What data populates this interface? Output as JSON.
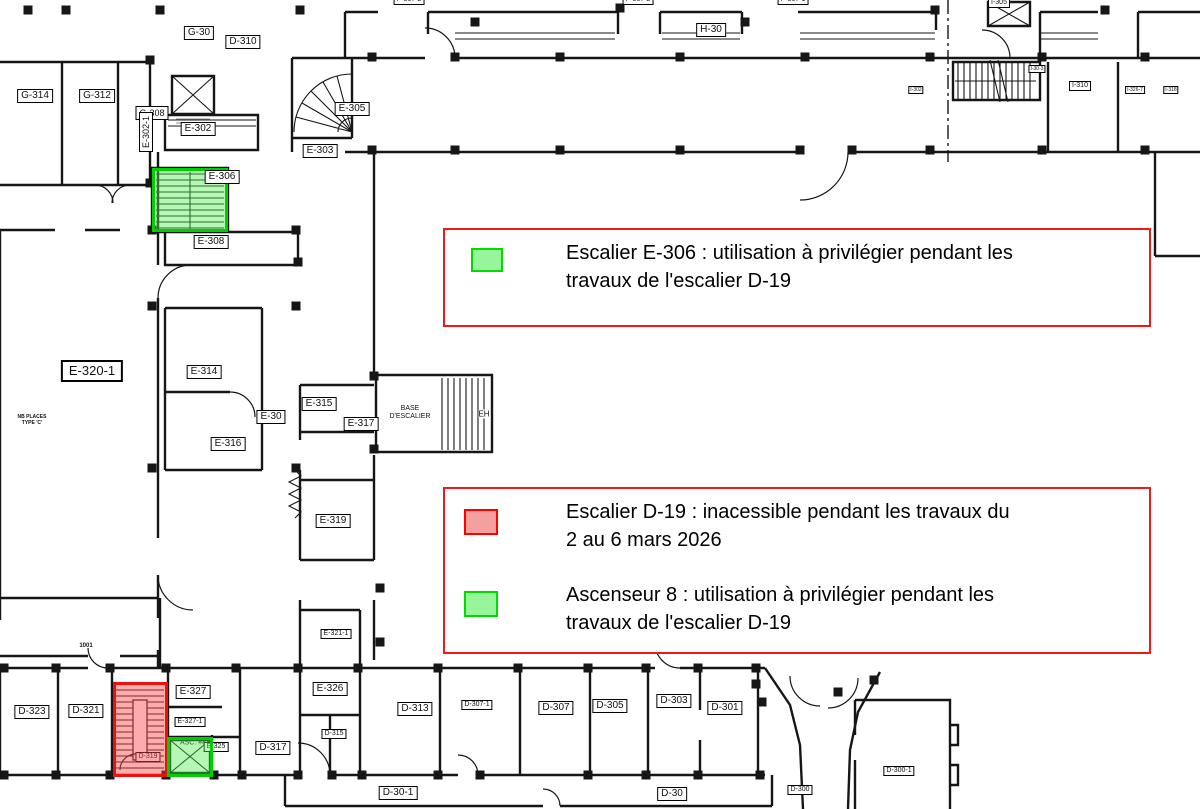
{
  "colors": {
    "line": "#161616",
    "legend_border": "#f21818",
    "highlight_green_fill": "rgba(80,235,80,0.42)",
    "highlight_green_border": "#00ce00",
    "highlight_red_fill": "rgba(250,70,70,0.45)",
    "highlight_red_border": "#ee0f0f",
    "swatch_green_fill": "#99f599",
    "swatch_green_border": "#00dc00",
    "swatch_red_fill": "#f5a0a0",
    "swatch_red_border": "#ff0000"
  },
  "legend": {
    "box1": {
      "item1": {
        "swatch_color": "green",
        "text": "Escalier E-306 : utilisation à privilégier pendant les\ntravaux de l'escalier D-19"
      }
    },
    "box2": {
      "item1": {
        "swatch_color": "red",
        "text": "Escalier D-19 : inacessible pendant les travaux du\n2 au 6 mars 2026"
      },
      "item2": {
        "swatch_color": "green",
        "text": "Ascenseur 8 : utilisation à privilégier pendant les\ntravaux de l'escalier D-19"
      }
    }
  },
  "highlights": {
    "escalier_e306": "green",
    "escalier_d19": "red",
    "ascenseur_8": "green"
  },
  "rooms": {
    "g30": "G-30",
    "d310": "D-310",
    "g314": "G-314",
    "g312": "G-312",
    "g308": "G-308",
    "e302_1": "E-302-1",
    "e302": "E-302",
    "e305": "E-305",
    "e303": "E-303",
    "e306": "E-306",
    "e308": "E-308",
    "h30": "H-30",
    "p307_2a": "P-307-2",
    "p307_2b": "P-307-2",
    "p307_1": "P-307-1",
    "i305": "I-305",
    "i302": "I-302",
    "i30_3": "I-30-3",
    "i310": "I-310",
    "i326_7": "I-326-7",
    "i318": "I-318",
    "e320_1": "E-320-1",
    "e314": "E-314",
    "e315": "E-315",
    "e30": "E-30",
    "e317": "E-317",
    "e316": "E-316",
    "e319": "E-319",
    "e321_1": "E-321-1",
    "e326": "E-326",
    "e327": "E-327",
    "e327_1": "E-327-1",
    "e325": "E-325",
    "d323": "D-323",
    "d321": "D-321",
    "d319": "D-319",
    "d317": "D-317",
    "d315": "D-315",
    "d313": "D-313",
    "d307_1": "D-307-1",
    "d307": "D-307",
    "d305": "D-305",
    "d303": "D-303",
    "d301": "D-301",
    "d300": "D-300",
    "d300_1": "D-300-1",
    "d30_1": "D-30-1",
    "d30": "D-30"
  },
  "annotations": {
    "base_escalier": "BASE\nD'ESCALIER",
    "eh": "EH",
    "places": "NB PLACES\nTYPE 'C'",
    "room1001": "1001",
    "asc8": "ASC. #8"
  }
}
